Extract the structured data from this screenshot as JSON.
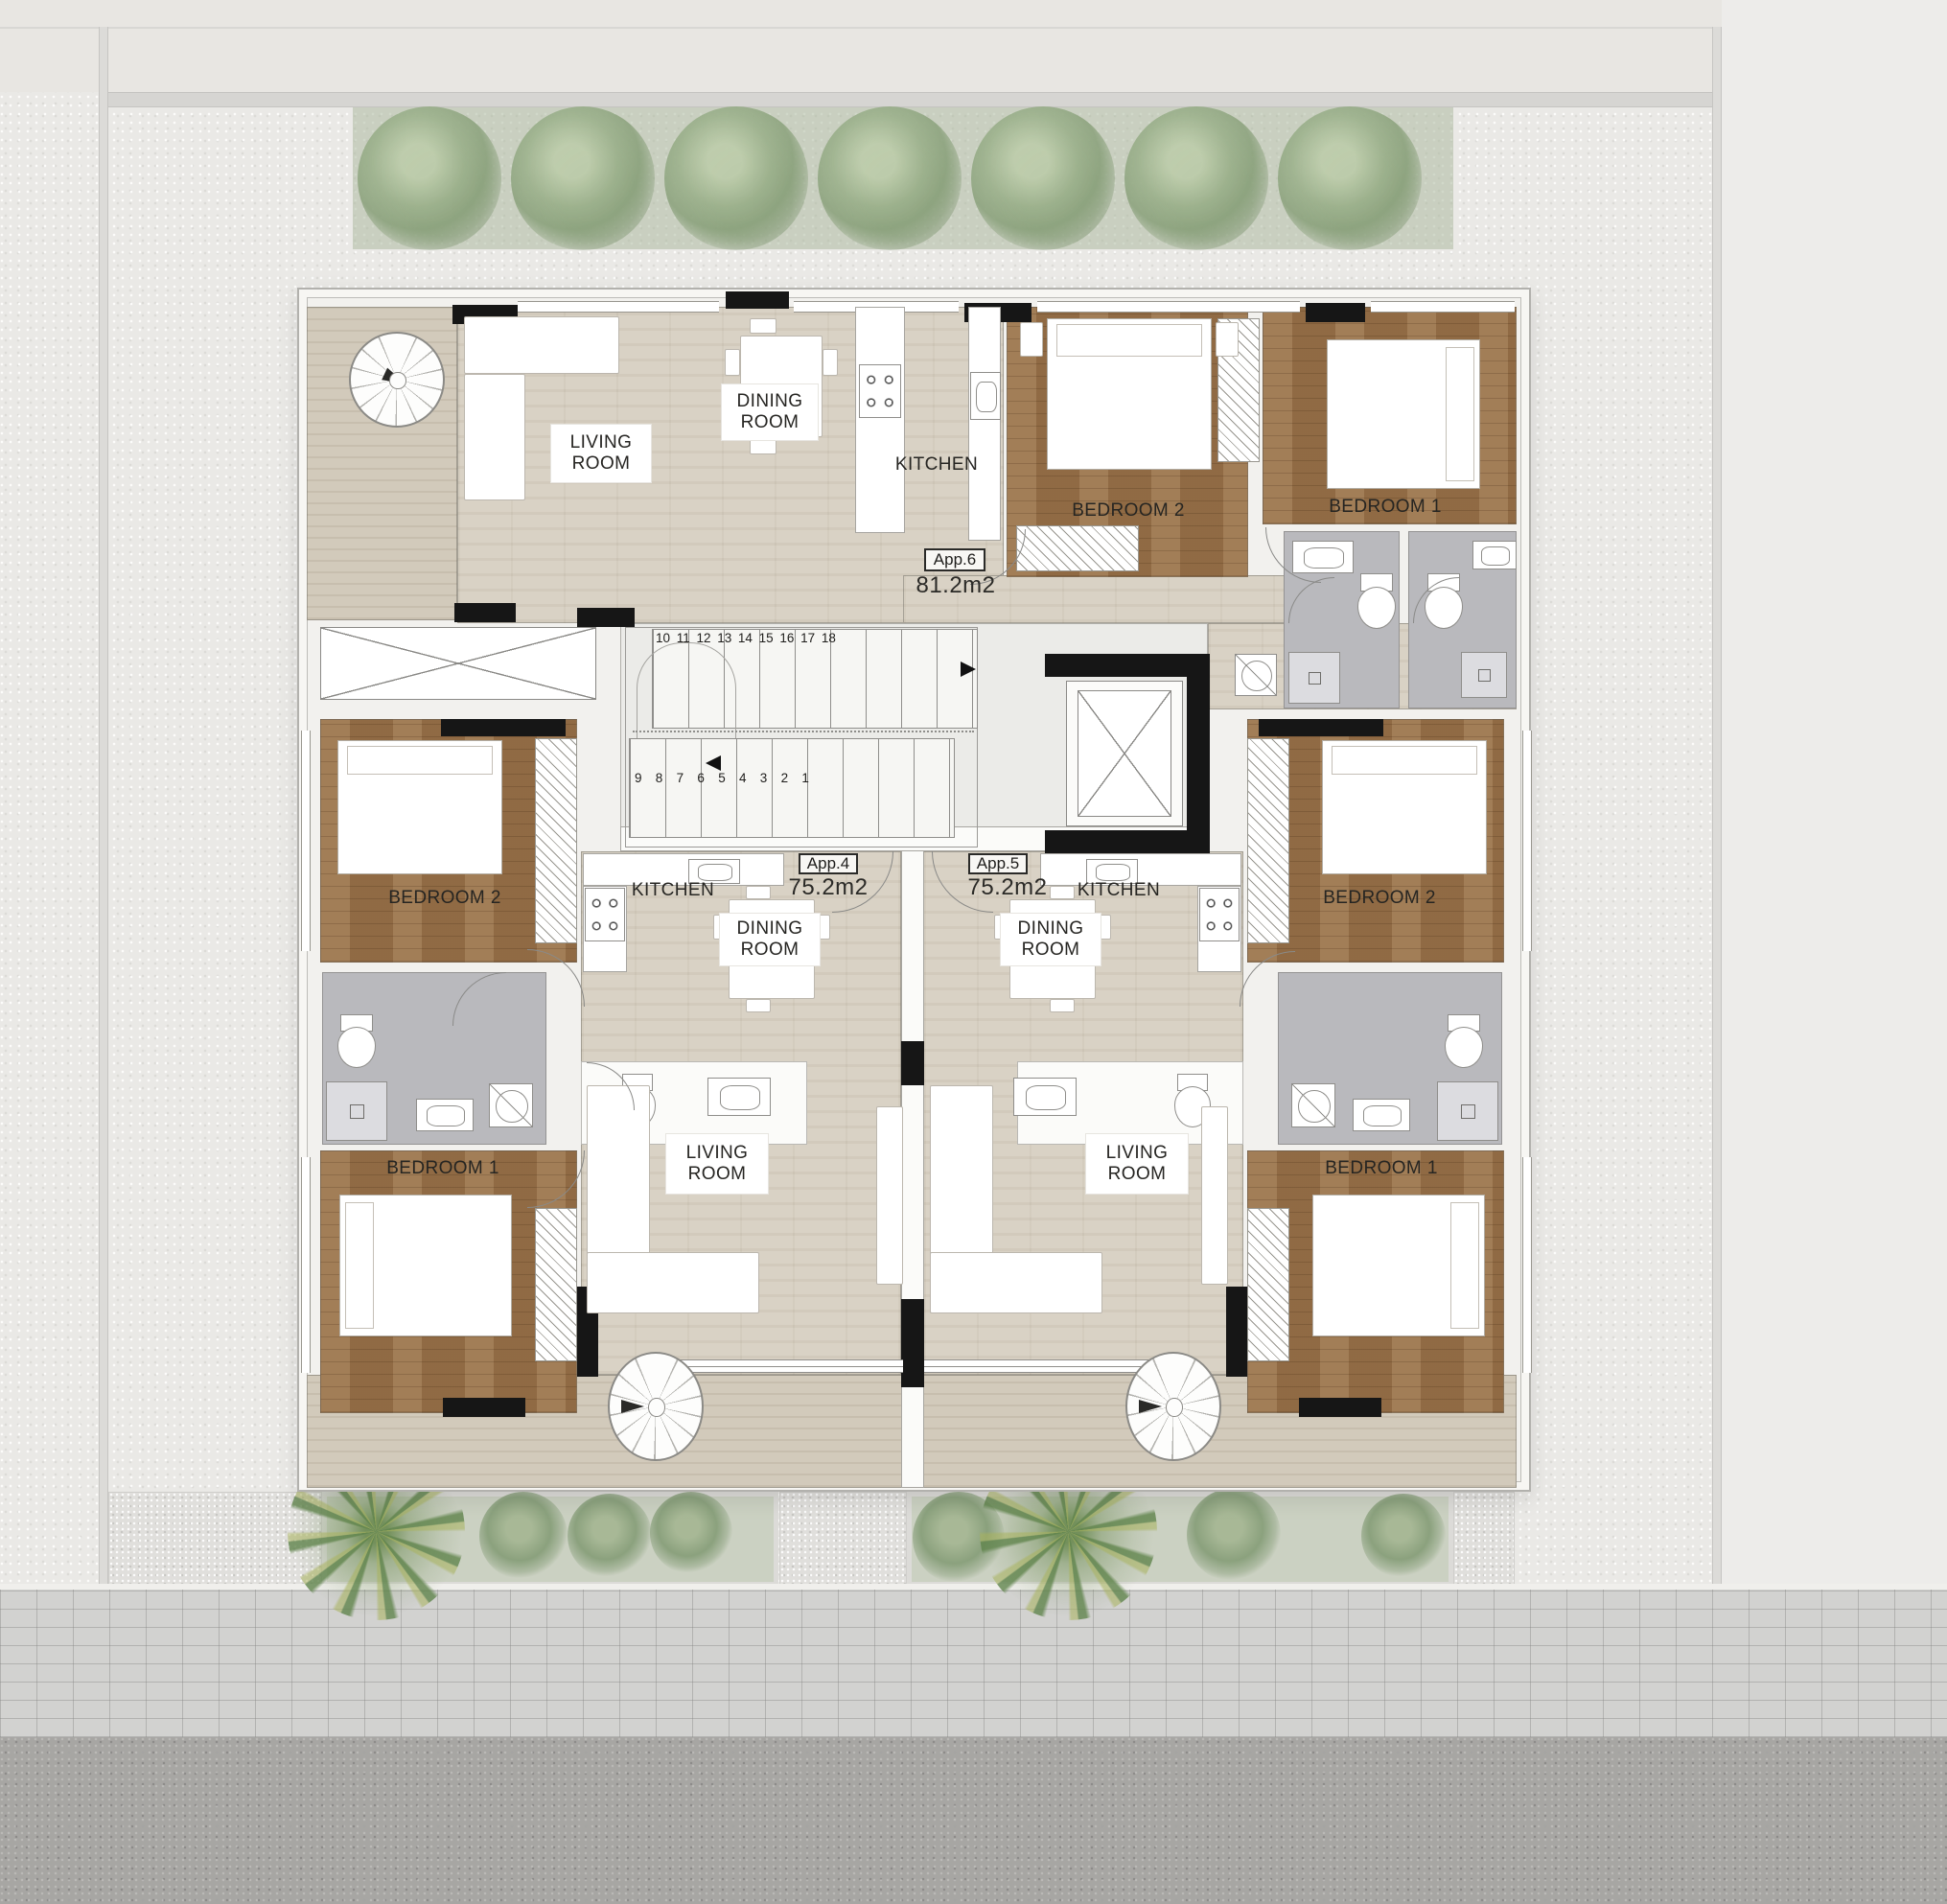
{
  "apartments": [
    {
      "id": "App.6",
      "area": "81.2m2",
      "rooms": {
        "living": "LIVING ROOM",
        "dining": "DINING ROOM",
        "kitchen": "KITCHEN",
        "bedroom2": "BEDROOM 2",
        "bedroom1": "BEDROOM 1"
      }
    },
    {
      "id": "App.4",
      "area": "75.2m2",
      "rooms": {
        "living": "LIVING ROOM",
        "dining": "DINING ROOM",
        "kitchen": "KITCHEN",
        "bedroom2": "BEDROOM 2",
        "bedroom1": "BEDROOM 1"
      }
    },
    {
      "id": "App.5",
      "area": "75.2m2",
      "rooms": {
        "living": "LIVING ROOM",
        "dining": "DINING ROOM",
        "kitchen": "KITCHEN",
        "bedroom2": "BEDROOM 2",
        "bedroom1": "BEDROOM 1"
      }
    }
  ],
  "stairs": {
    "upper": [
      "10",
      "11",
      "12",
      "13",
      "14",
      "15",
      "16",
      "17",
      "18"
    ],
    "lower": [
      "9",
      "8",
      "7",
      "6",
      "5",
      "4",
      "3",
      "2",
      "1"
    ]
  },
  "icons": {
    "spiral-staircase-icon": "circle-with-radial-spokes-and-arrow",
    "elevator-icon": "box-with-x-cross",
    "staircase-icon": "parallel-treads-with-step-numbers",
    "toilet-icon": "tank-and-bowl-ellipse",
    "sink-icon": "rect-with-inner-basin",
    "stove-icon": "four-burner-rings",
    "shower-icon": "gray-square-with-drain",
    "washing-machine-icon": "square-with-circle-and-slash",
    "wardrobe-icon": "diagonal-hatch-strip",
    "tree-icon": "soft-green-circle",
    "palm-tree-icon": "green-starburst",
    "door-swing-icon": "quarter-arc"
  },
  "colors": {
    "background": "#eae9e6",
    "wood_floor": "#9a7349",
    "travertine_floor": "#d9d2c5",
    "terrace_floor": "#d2cabb",
    "bathroom_floor": "#b9b9bd",
    "hall_floor": "#ebebe8",
    "wall_black": "#161616",
    "tree_green": "#9cb18c",
    "paving": "#d2d2d0",
    "road": "#a7a6a3"
  }
}
